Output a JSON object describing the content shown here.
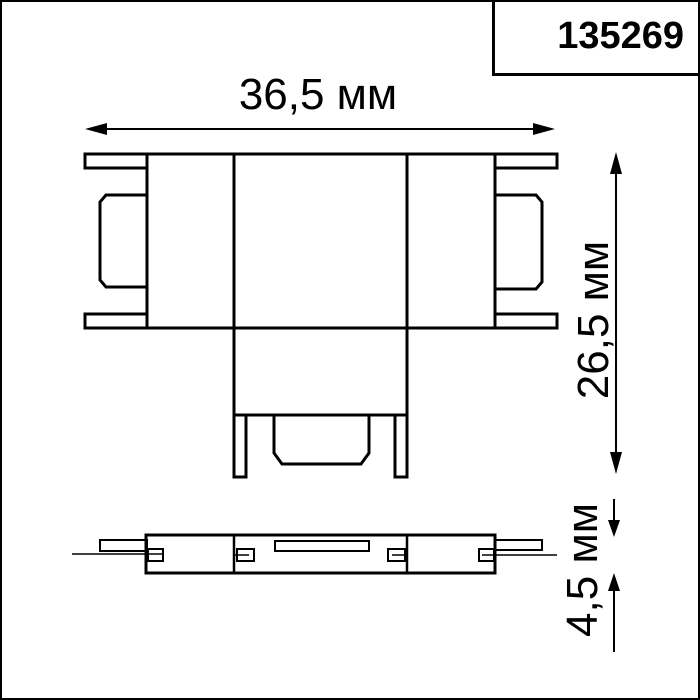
{
  "header": {
    "product_code": "135269"
  },
  "dimension_labels": {
    "width": "36,5 мм",
    "height": "26,5 мм",
    "thickness": "4,5 мм"
  },
  "colors": {
    "line": "#000000",
    "background": "#ffffff",
    "text": "#000000"
  }
}
